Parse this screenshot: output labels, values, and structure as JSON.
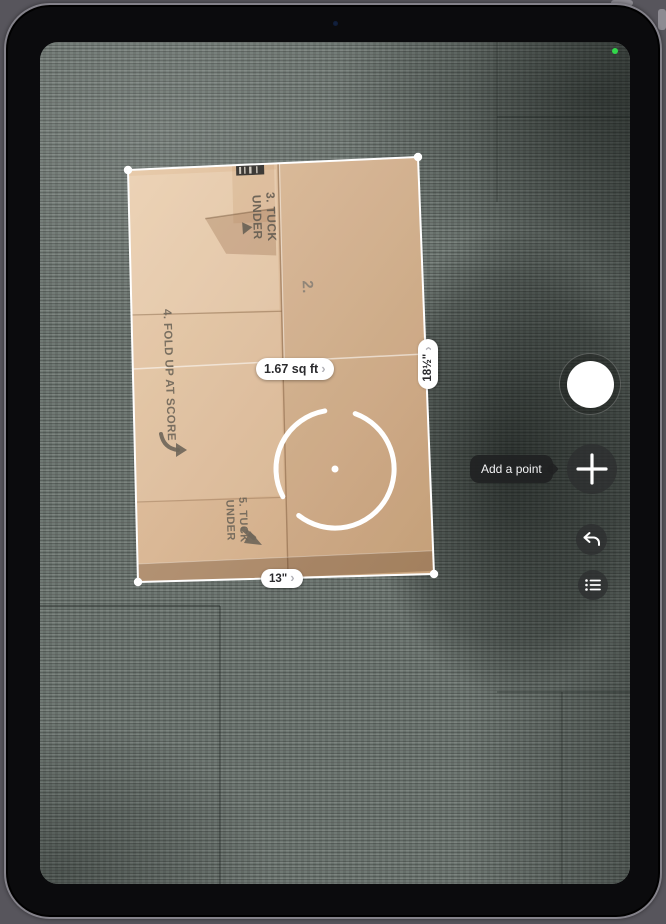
{
  "device": {
    "type": "ipad-camera-view",
    "camera_indicator_color": "#32d74b"
  },
  "measure": {
    "tooltip": "Add a point",
    "labels": {
      "area": "1.67 sq ft",
      "width": "13\"",
      "height": "18½\""
    }
  },
  "icons": {
    "chevron": "›"
  },
  "box_print": {
    "step3_line1": "3. TUCK",
    "step3_line2": "UNDER",
    "step2": "2.",
    "step4": "4. FOLD UP AT SCORE",
    "step5_line1": "5. TUCK",
    "step5_line2": "UNDER"
  },
  "colors": {
    "cardboard": "#d9b795",
    "carpet": "#6b746f",
    "overlay_white": "#ffffff",
    "label_text": "#2b2b2e",
    "tooltip_bg": "#202122"
  }
}
